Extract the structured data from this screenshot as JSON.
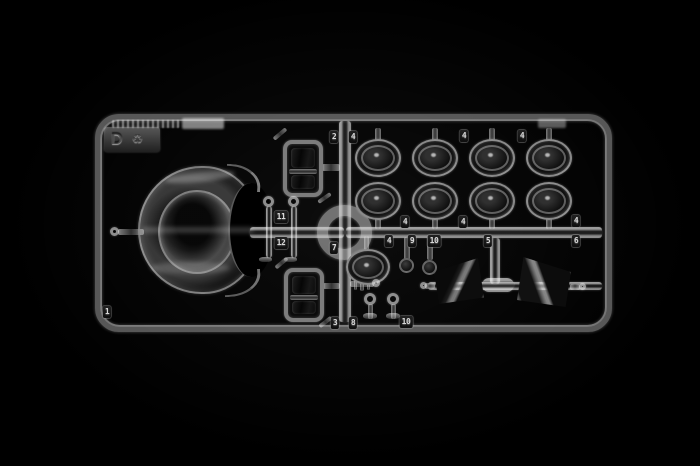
{
  "sprue": {
    "gate_letter": "D",
    "recycling_symbol": "♻",
    "part_tags": {
      "t1": "1",
      "t2": "2",
      "t3": "4",
      "t4": "4",
      "t5": "4",
      "t6": "4",
      "t7": "4",
      "t8": "4",
      "t9": "4",
      "t10": "9",
      "t11": "10",
      "t12": "5",
      "t13": "6",
      "t14": "7",
      "t15": "11",
      "t16": "12",
      "t17": "3",
      "t18": "8",
      "t19": "10"
    },
    "colors": {
      "background": "#000000",
      "plastic_highlight": "#e9e9e9",
      "plastic_mid": "#9a9a9a",
      "tag_background": "#161616",
      "tag_text": "#d8d8d8"
    }
  }
}
